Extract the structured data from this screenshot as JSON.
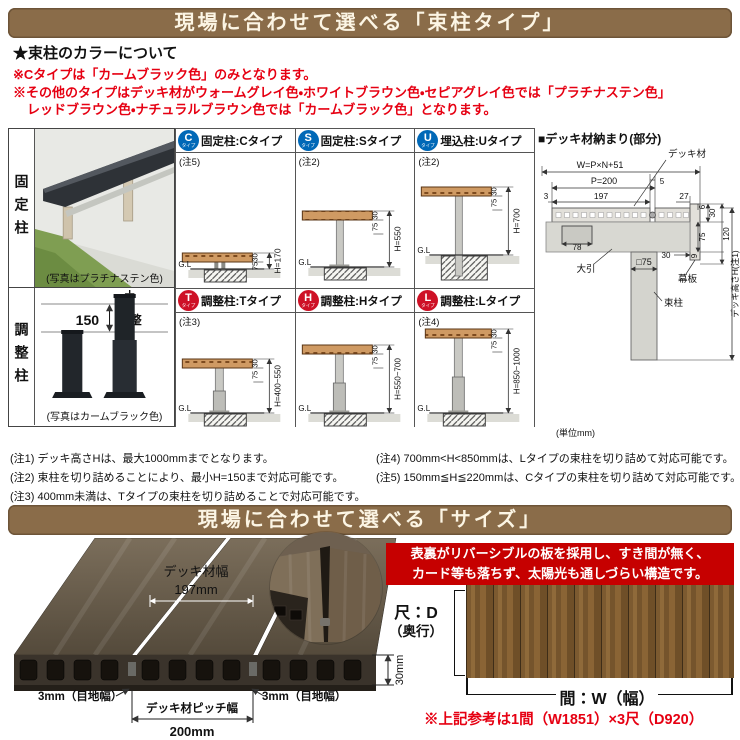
{
  "colors": {
    "banner_brown": "#8a6c49",
    "note_red": "#e60012",
    "feature_banner_red": "#c60000",
    "badge_blue": "#0068b7",
    "badge_red": "#ce1126",
    "wood_tan": "#cf9a63"
  },
  "section1": {
    "banner": "現場に合わせて選べる「束柱タイプ」",
    "color_heading": "★束柱のカラーについて",
    "color_note1": "※Cタイプは「カームブラック色」のみとなります。",
    "color_note2a": "※その他のタイプはデッキ材がウォームグレイ色・ホワイトブラウン色・セピアグレイ色では「プラチナステン色」",
    "color_note2b": "レッドブラウン色・ナチュラルブラウン色では「カームブラック色」となります。"
  },
  "left_panel": {
    "fixed_label": "固定柱",
    "fixed_caption": "(写真はプラチナステン色)",
    "adjust_label": "調整柱",
    "adjust_value": "150",
    "adjust_word": "調整",
    "adjust_caption": "(写真はカームブラック色)"
  },
  "types": [
    {
      "letter": "C",
      "sub": "タイプ",
      "title": "固定柱:Cタイプ",
      "note": "(注5)",
      "gl": "G.L",
      "dim30": "30",
      "dim75": "75",
      "height": "H=170"
    },
    {
      "letter": "S",
      "sub": "タイプ",
      "title": "固定柱:Sタイプ",
      "note": "(注2)",
      "gl": "G.L",
      "dim30": "30",
      "dim75": "75",
      "height": "H=550"
    },
    {
      "letter": "U",
      "sub": "タイプ",
      "title": "埋込柱:Uタイプ",
      "note": "(注2)",
      "gl": "G.L",
      "dim30": "30",
      "dim75": "75",
      "height": "H=700"
    },
    {
      "letter": "T",
      "sub": "タイプ",
      "title": "調整柱:Tタイプ",
      "note": "(注3)",
      "gl": "G.L",
      "dim30": "30",
      "dim75": "75",
      "height": "H=400~550"
    },
    {
      "letter": "H",
      "sub": "タイプ",
      "title": "調整柱:Hタイプ",
      "note": "",
      "gl": "G.L",
      "dim30": "30",
      "dim75": "75",
      "height": "H=550~700"
    },
    {
      "letter": "L",
      "sub": "タイプ",
      "title": "調整柱:Lタイプ",
      "note": "(注4)",
      "gl": "G.L",
      "dim30": "30",
      "dim75": "75",
      "height": "H=850~1000"
    }
  ],
  "detail": {
    "title": "■デッキ材納まり(部分)",
    "deck_label": "デッキ材",
    "w_formula": "W=P×N+51",
    "p": "P=200",
    "gap5": "5",
    "d3": "3",
    "d197": "197",
    "d27": "27",
    "d6": "6",
    "d30_top": "30",
    "d78": "78",
    "d75": "75",
    "d120": "120",
    "obiki": "大引",
    "d30_bottom": "30",
    "d9": "9",
    "makuita": "幕板",
    "post_size": "□75",
    "post_label": "束柱",
    "height_label": "デッキ高さH(注1)",
    "unit": "(単位mm)"
  },
  "footnotes": {
    "n1": "(注1) デッキ高さHは、最大1000mmまでとなります。",
    "n2": "(注2) 束柱を切り詰めることにより、最小H=150まで対応可能です。",
    "n3": "(注3) 400mm未満は、Tタイプの束柱を切り詰めることで対応可能です。",
    "n4": "(注4) 700mm<H<850mmは、Lタイプの束柱を切り詰めて対応可能です。",
    "n5": "(注5) 150mm≦H≦220mmは、Cタイプの束柱を切り詰めて対応可能です。"
  },
  "section2": {
    "banner": "現場に合わせて選べる「サイズ」",
    "deck_width_label": "デッキ材幅",
    "deck_width_value": "197mm",
    "joint_left": "3mm（目地幅）",
    "joint_right": "3mm（目地幅）",
    "pitch_label": "デッキ材ピッチ幅",
    "pitch_value": "200mm",
    "thickness": "30mm",
    "feature_line1": "表裏がリバーシブルの板を採用し、すき間が無く、",
    "feature_line2": "カード等も落ちず、太陽光も通しづらい構造です。",
    "depth_line1": "尺：D",
    "depth_line2": "（奥行）",
    "width_label": "間：W（幅）",
    "reference": "※上記参考は1間（W1851）×3尺（D920）"
  }
}
